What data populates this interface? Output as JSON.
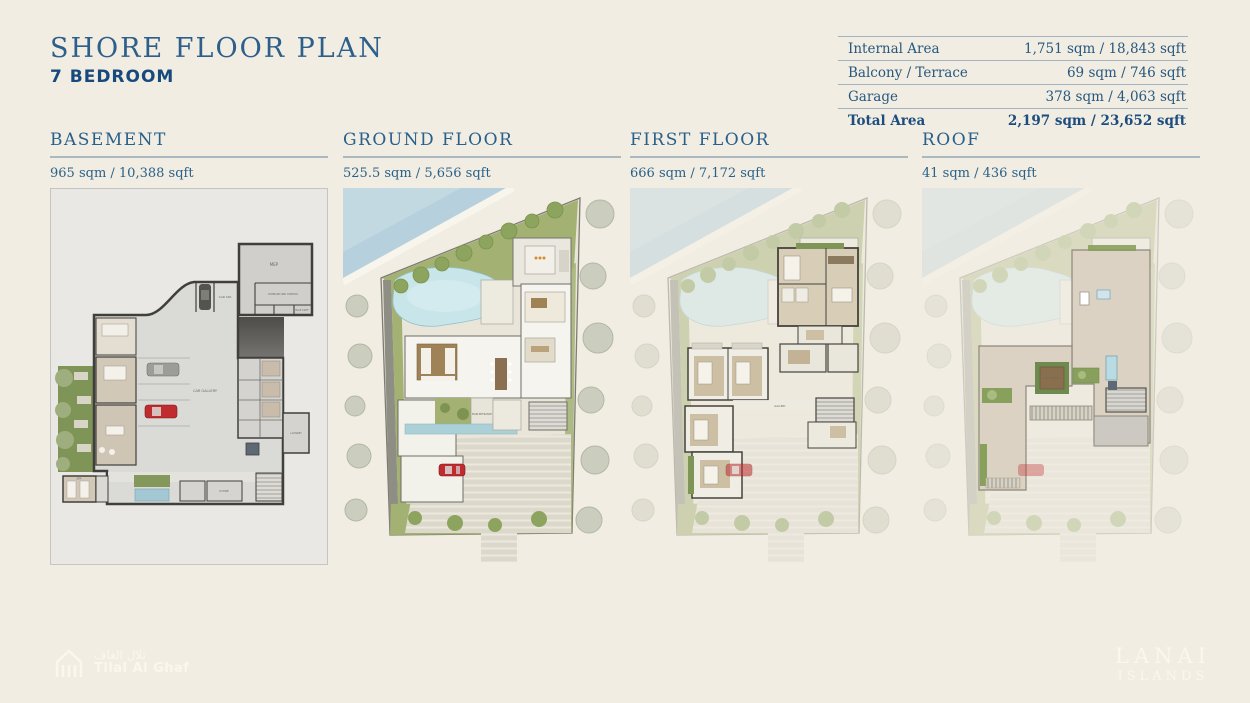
{
  "header": {
    "title": "SHORE FLOOR PLAN",
    "subtitle": "7 BEDROOM"
  },
  "area_table": {
    "rows": [
      {
        "label": "Internal Area",
        "value": "1,751 sqm / 18,843 sqft"
      },
      {
        "label": "Balcony / Terrace",
        "value": "69 sqm / 746 sqft"
      },
      {
        "label": "Garage",
        "value": "378 sqm / 4,063 sqft"
      },
      {
        "label": "Total Area",
        "value": "2,197 sqm / 23,652 sqft"
      }
    ]
  },
  "floors": [
    {
      "name": "BASEMENT",
      "area": "965 sqm / 10,388 sqft"
    },
    {
      "name": "GROUND FLOOR",
      "area": "525.5 sqm / 5,656 sqft"
    },
    {
      "name": "FIRST FLOOR",
      "area": "666 sqm / 7,172 sqft"
    },
    {
      "name": "ROOF",
      "area": "41 sqm / 436 sqft"
    }
  ],
  "plan_labels": {
    "car_gallery": "CAR GALLERY",
    "car_spa": "CAR SPA",
    "mep": "MEP",
    "command_and_control": "COMMAND AND CONTROL",
    "male_staff": "MALE STAFF",
    "lift": "LIFT",
    "laundry": "LAUNDRY",
    "store": "STORE",
    "spa": "SPA",
    "main_entrance": "MAIN ENTRANCE",
    "gallery": "GALLERY",
    "roof_terrace": "ROOF TERRACE"
  },
  "footer": {
    "developer_logo_arabic": "تلال الغاف",
    "developer_logo_text": "Tilal Al Ghaf",
    "project_logo_line1": "LANAI",
    "project_logo_line2": "ISLANDS"
  },
  "colors": {
    "background_cream": "#f1ede2",
    "accent_blue": "#2a5d88",
    "rule_gray_blue": "#aab8c2",
    "water_blue": "#b6d0dd",
    "landscape_green": "#a3b173",
    "red_car": "#bf2b2e",
    "roof_beige": "#dbd2c3"
  }
}
